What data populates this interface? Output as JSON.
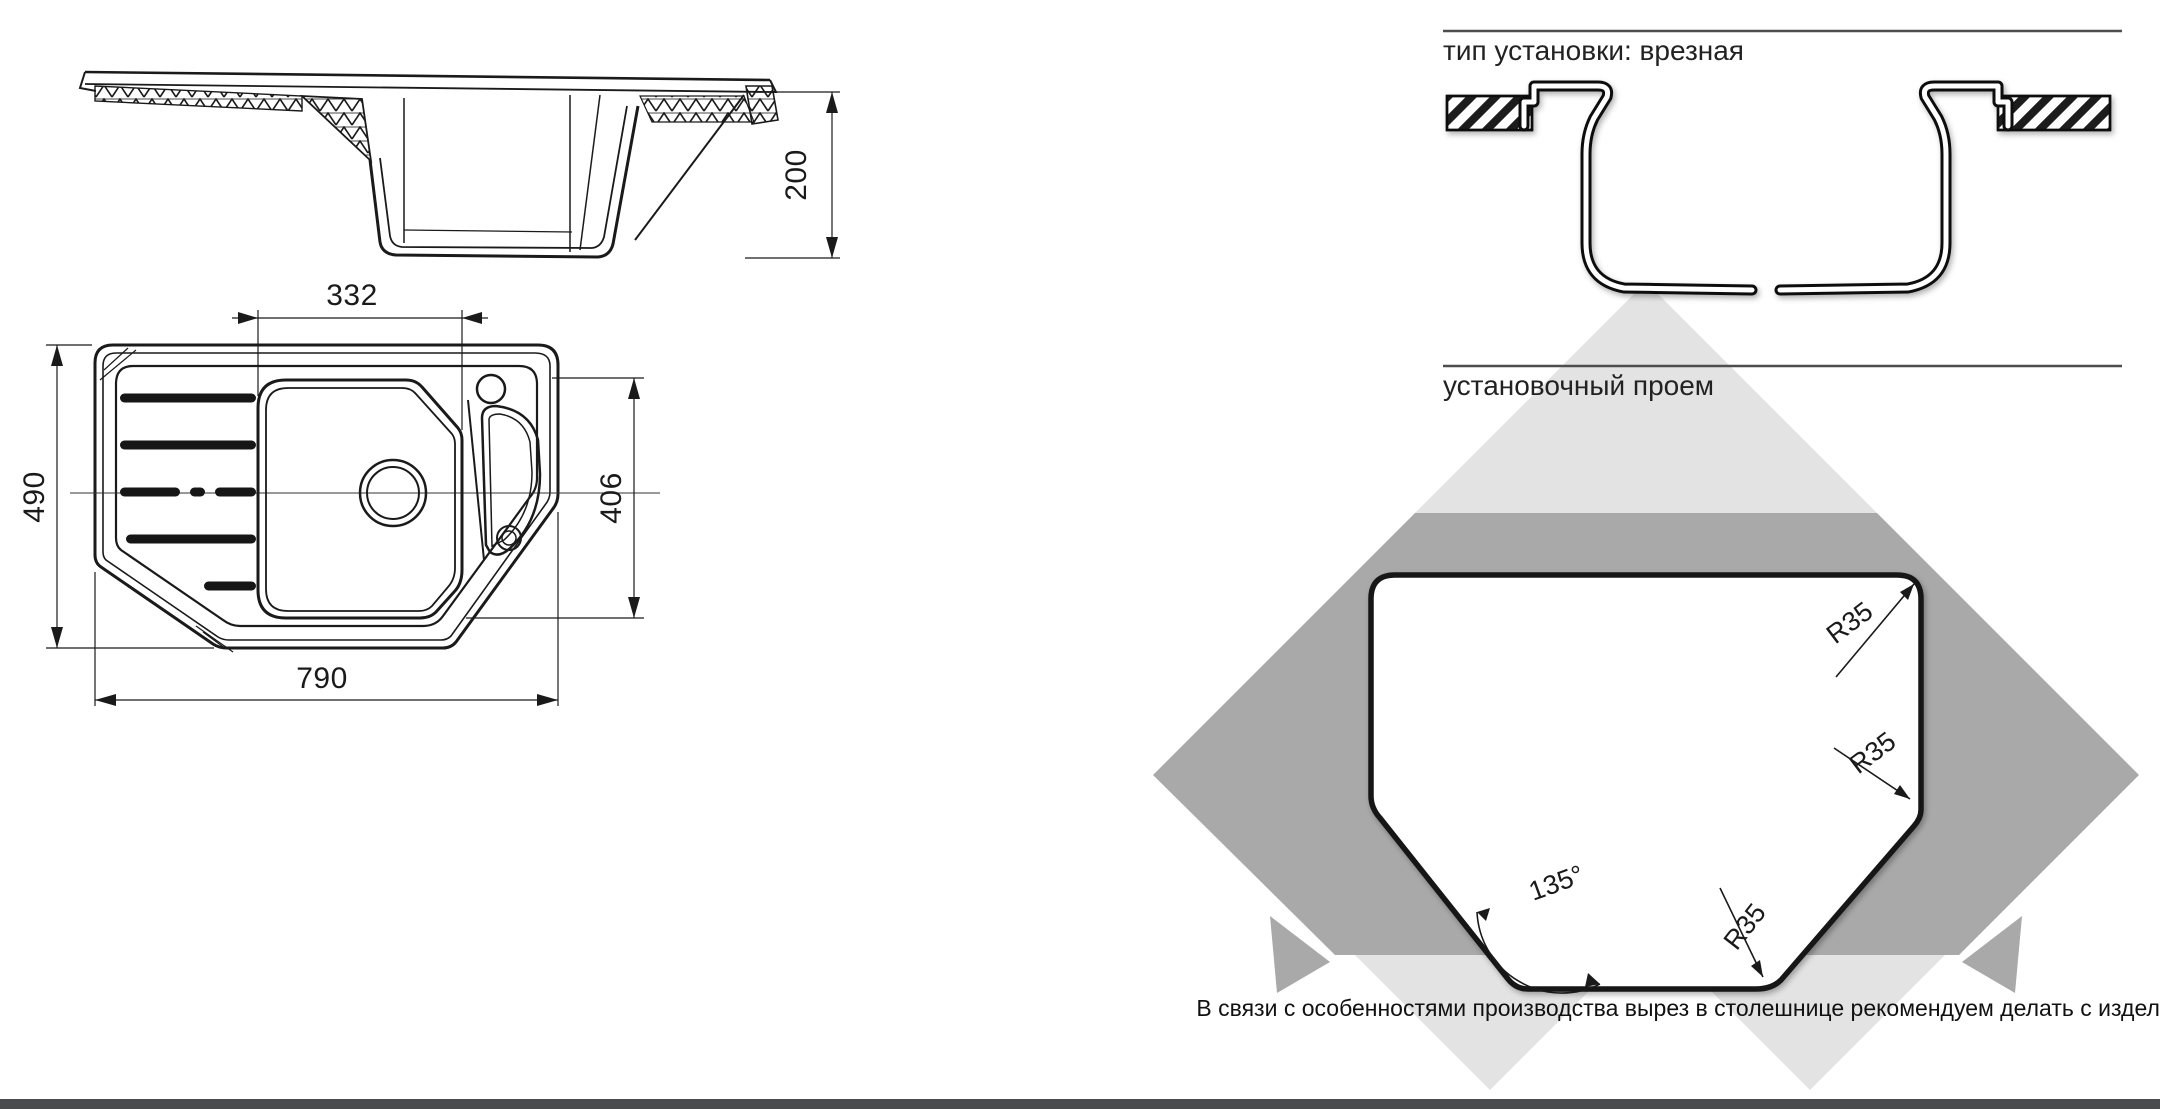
{
  "left_drawings": {
    "side_view": {
      "height_dim": "200"
    },
    "top_view": {
      "bowl_width_dim": "332",
      "overall_width_dim": "790",
      "overall_depth_dim": "490",
      "bowl_depth_dim": "406"
    }
  },
  "right_panel": {
    "install_type_title": "тип установки: врезная",
    "opening_title": "установочный проем",
    "radius_label_1": "R35",
    "radius_label_2": "R35",
    "radius_label_3": "R35",
    "angle_label": "135°",
    "note": "В связи с особенностями производства вырез в столешнице рекомендуем делать с изделия."
  },
  "colors": {
    "line": "#1a1a1a",
    "diamond_light": "#e3e3e3",
    "diamond_dark": "#a9a9a9",
    "rule": "#4d4d4d",
    "footer_bar": "#4a4b4d",
    "cutout_fill": "#ffffff"
  }
}
